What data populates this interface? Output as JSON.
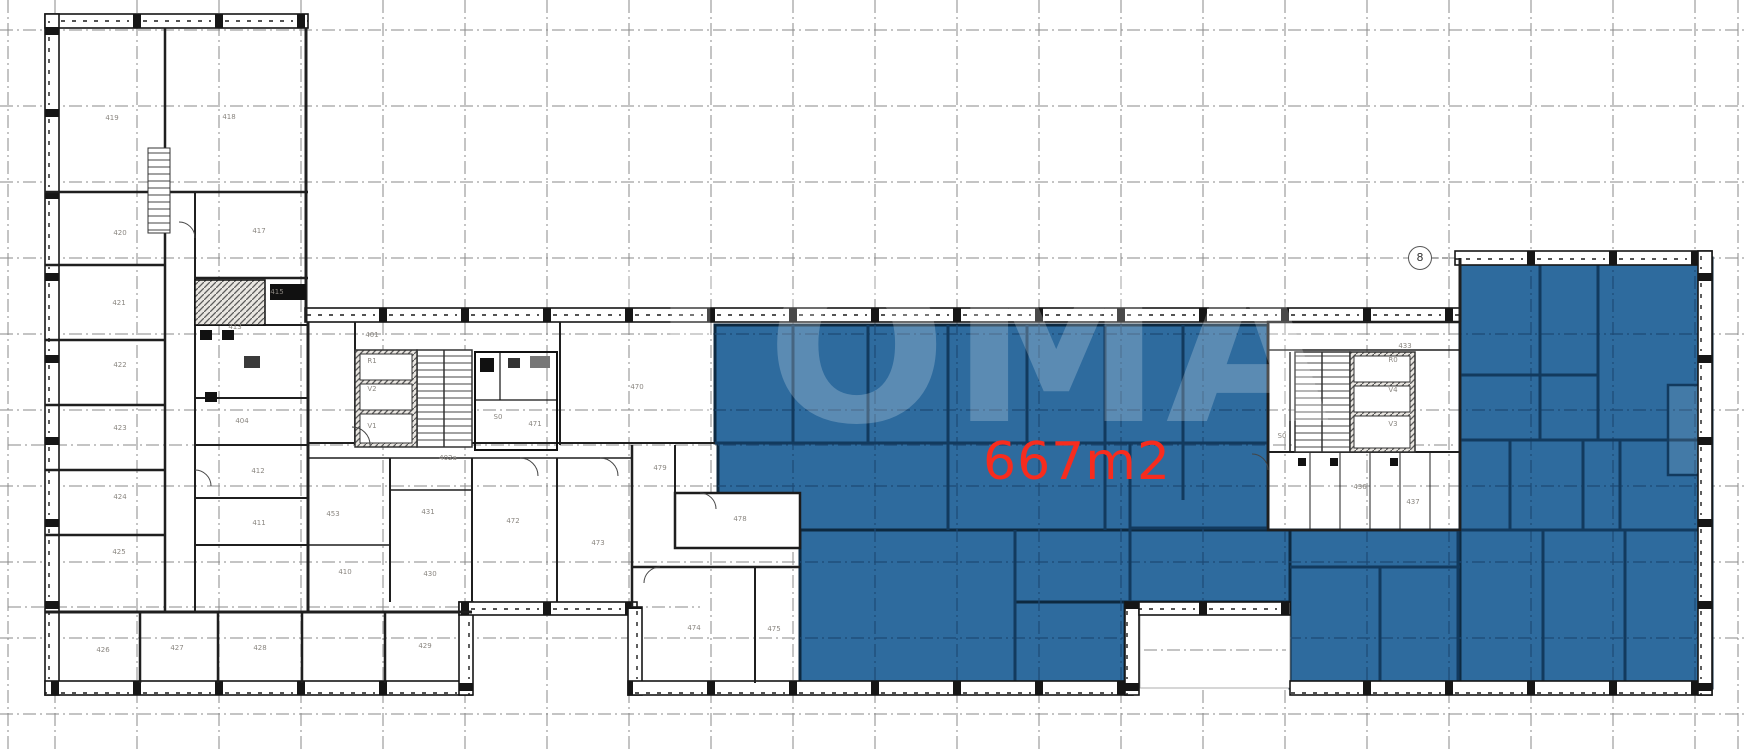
{
  "drawing": {
    "watermark": {
      "text": "ТОМА",
      "opacity": 0.22
    },
    "area_label": {
      "text": "667m2",
      "color": "#f72c1e"
    },
    "grid_bubble": {
      "label": "8"
    },
    "colors": {
      "highlight_fill": "#2e6b9e",
      "highlight_wall": "#112f4e",
      "wall": "#1c1c1c",
      "grid_line": "#787878",
      "grid_line_on_highlight": "#1d4a75",
      "room_label_text": "#8a8680"
    },
    "rooms": [
      {
        "label": "419",
        "x": 112,
        "y": 118
      },
      {
        "label": "418",
        "x": 229,
        "y": 117
      },
      {
        "label": "420",
        "x": 120,
        "y": 233
      },
      {
        "label": "417",
        "x": 259,
        "y": 231
      },
      {
        "label": "421",
        "x": 119,
        "y": 303
      },
      {
        "label": "415",
        "x": 277,
        "y": 292
      },
      {
        "label": "413",
        "x": 235,
        "y": 327
      },
      {
        "label": "422",
        "x": 120,
        "y": 365
      },
      {
        "label": "404",
        "x": 242,
        "y": 421
      },
      {
        "label": "423",
        "x": 120,
        "y": 428
      },
      {
        "label": "412",
        "x": 258,
        "y": 471
      },
      {
        "label": "424",
        "x": 120,
        "y": 497
      },
      {
        "label": "411",
        "x": 259,
        "y": 523
      },
      {
        "label": "425",
        "x": 119,
        "y": 552
      },
      {
        "label": "426",
        "x": 103,
        "y": 650
      },
      {
        "label": "427",
        "x": 177,
        "y": 648
      },
      {
        "label": "428",
        "x": 260,
        "y": 648
      },
      {
        "label": "429",
        "x": 425,
        "y": 646
      },
      {
        "label": "410",
        "x": 345,
        "y": 572
      },
      {
        "label": "430",
        "x": 430,
        "y": 574
      },
      {
        "label": "453",
        "x": 333,
        "y": 514
      },
      {
        "label": "431",
        "x": 428,
        "y": 512
      },
      {
        "label": "402a",
        "x": 448,
        "y": 458
      },
      {
        "label": "401",
        "x": 372,
        "y": 335
      },
      {
        "label": "R1",
        "x": 372,
        "y": 361
      },
      {
        "label": "V2",
        "x": 372,
        "y": 389
      },
      {
        "label": "V1",
        "x": 372,
        "y": 426
      },
      {
        "label": "S0",
        "x": 498,
        "y": 417
      },
      {
        "label": "471",
        "x": 535,
        "y": 424
      },
      {
        "label": "470",
        "x": 637,
        "y": 387
      },
      {
        "label": "479",
        "x": 660,
        "y": 468
      },
      {
        "label": "478",
        "x": 740,
        "y": 519
      },
      {
        "label": "472",
        "x": 513,
        "y": 521
      },
      {
        "label": "473",
        "x": 598,
        "y": 543
      },
      {
        "label": "474",
        "x": 694,
        "y": 628
      },
      {
        "label": "475",
        "x": 774,
        "y": 629
      },
      {
        "label": "433",
        "x": 1405,
        "y": 346
      },
      {
        "label": "R0",
        "x": 1393,
        "y": 360
      },
      {
        "label": "V4",
        "x": 1393,
        "y": 390
      },
      {
        "label": "V3",
        "x": 1393,
        "y": 424
      },
      {
        "label": "S0",
        "x": 1282,
        "y": 436
      },
      {
        "label": "436",
        "x": 1360,
        "y": 487
      },
      {
        "label": "437",
        "x": 1413,
        "y": 502
      }
    ]
  }
}
